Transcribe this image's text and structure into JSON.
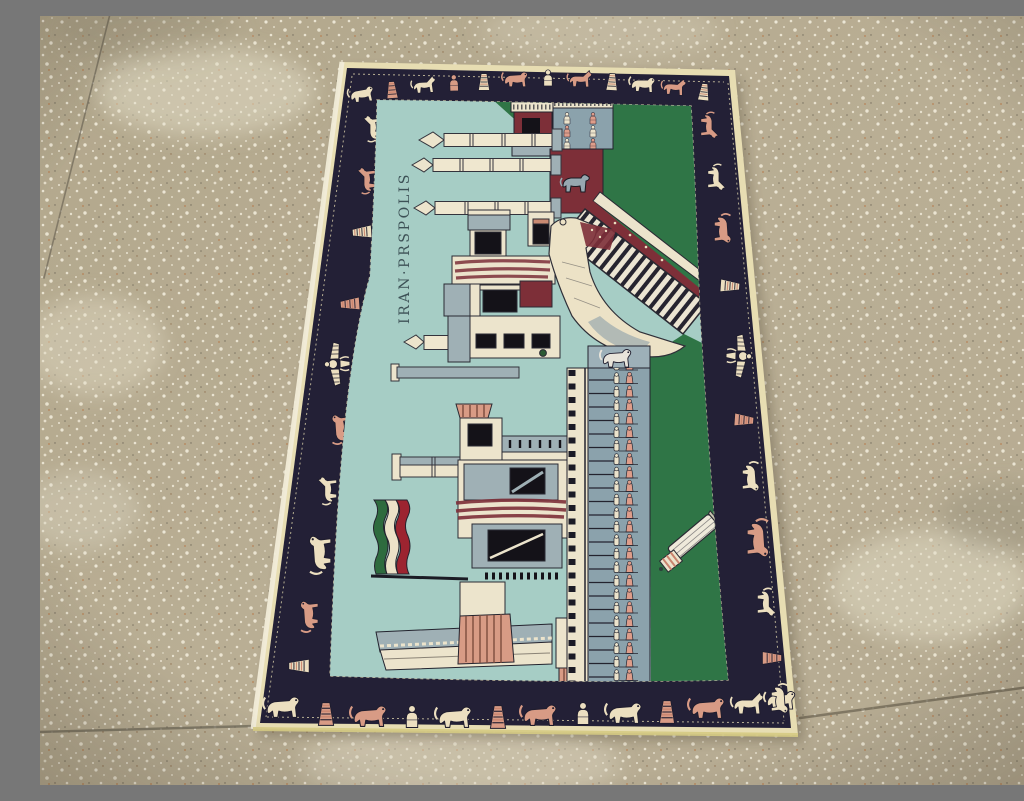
{
  "scene": {
    "description": "Photograph of a pictorial Persian rug depicting the ruins of Persepolis, lying flat on a speckled beige terrazzo floor",
    "floor": "speckled beige terrazzo with thin grout lines",
    "lighting": "soft indoor light, lighter patches on floor"
  },
  "rug": {
    "inscription": "IRAN·PRSPOLIS",
    "inscription_orientation": "woven vertically, reads bottom to top",
    "subject": "Persepolis ruins: columns, Gate of All Nations, grand staircase, soldier procession reliefs, bull relief panel, fallen column, flag of Iran",
    "border_motif_names": [
      "lion",
      "horse",
      "bull",
      "striped cone",
      "faravahar winged emblem",
      "seated figure"
    ],
    "flag_stripe_colors": [
      "#2e6b3e",
      "#ece2c8",
      "#9c2430"
    ],
    "border_motif_placements": [
      {
        "t": "lion",
        "x": 322,
        "y": 79,
        "r": -6,
        "s": 0.75,
        "c": "cream"
      },
      {
        "t": "cone",
        "x": 352,
        "y": 74,
        "r": -4,
        "s": 0.7,
        "c": "pink"
      },
      {
        "t": "horse",
        "x": 384,
        "y": 70,
        "r": -3,
        "s": 0.75,
        "c": "cream"
      },
      {
        "t": "figure",
        "x": 414,
        "y": 68,
        "r": -2,
        "s": 0.7,
        "c": "pink"
      },
      {
        "t": "cone",
        "x": 444,
        "y": 66,
        "r": 0,
        "s": 0.7,
        "c": "cream"
      },
      {
        "t": "lion",
        "x": 476,
        "y": 64,
        "r": 0,
        "s": 0.75,
        "c": "pink"
      },
      {
        "t": "figure",
        "x": 508,
        "y": 63,
        "r": 0,
        "s": 0.7,
        "c": "cream"
      },
      {
        "t": "horse",
        "x": 540,
        "y": 64,
        "r": 2,
        "s": 0.75,
        "c": "pink"
      },
      {
        "t": "cone",
        "x": 572,
        "y": 66,
        "r": 3,
        "s": 0.7,
        "c": "cream"
      },
      {
        "t": "lion",
        "x": 603,
        "y": 69,
        "r": 4,
        "s": 0.75,
        "c": "cream"
      },
      {
        "t": "horse",
        "x": 634,
        "y": 72,
        "r": 5,
        "s": 0.75,
        "c": "pink"
      },
      {
        "t": "cone",
        "x": 664,
        "y": 76,
        "r": 6,
        "s": 0.7,
        "c": "cream"
      },
      {
        "t": "lion",
        "x": 243,
        "y": 692,
        "r": 0,
        "s": 1.05,
        "c": "cream"
      },
      {
        "t": "cone",
        "x": 286,
        "y": 698,
        "r": 0,
        "s": 0.95,
        "c": "pink"
      },
      {
        "t": "lion",
        "x": 330,
        "y": 701,
        "r": 0,
        "s": 1.05,
        "c": "pink"
      },
      {
        "t": "figure",
        "x": 372,
        "y": 702,
        "r": 0,
        "s": 0.95,
        "c": "cream"
      },
      {
        "t": "lion",
        "x": 415,
        "y": 702,
        "r": 0,
        "s": 1.05,
        "c": "cream"
      },
      {
        "t": "cone",
        "x": 458,
        "y": 701,
        "r": 0,
        "s": 0.95,
        "c": "pink"
      },
      {
        "t": "lion",
        "x": 500,
        "y": 700,
        "r": 0,
        "s": 1.05,
        "c": "pink"
      },
      {
        "t": "figure",
        "x": 543,
        "y": 699,
        "r": 0,
        "s": 0.95,
        "c": "cream"
      },
      {
        "t": "lion",
        "x": 585,
        "y": 698,
        "r": 0,
        "s": 1.05,
        "c": "cream"
      },
      {
        "t": "cone",
        "x": 627,
        "y": 696,
        "r": 0,
        "s": 0.95,
        "c": "pink"
      },
      {
        "t": "lion",
        "x": 668,
        "y": 693,
        "r": 0,
        "s": 1.05,
        "c": "pink"
      },
      {
        "t": "horse",
        "x": 708,
        "y": 689,
        "r": 0,
        "s": 1.0,
        "c": "cream"
      },
      {
        "t": "lion",
        "x": 741,
        "y": 685,
        "r": 0,
        "s": 0.9,
        "c": "cream"
      },
      {
        "t": "horse",
        "x": 334,
        "y": 112,
        "r": -90,
        "s": 0.8,
        "c": "cream"
      },
      {
        "t": "horse",
        "x": 328,
        "y": 164,
        "r": -90,
        "s": 0.8,
        "c": "pink"
      },
      {
        "t": "cone",
        "x": 322,
        "y": 216,
        "r": -94,
        "s": 0.8,
        "c": "cream"
      },
      {
        "t": "cone",
        "x": 310,
        "y": 288,
        "r": -94,
        "s": 0.8,
        "c": "pink"
      },
      {
        "t": "faravahar",
        "x": 296,
        "y": 348,
        "r": -92,
        "s": 1.0,
        "c": "cream"
      },
      {
        "t": "lion",
        "x": 301,
        "y": 412,
        "r": -90,
        "s": 0.85,
        "c": "pink"
      },
      {
        "t": "horse",
        "x": 289,
        "y": 474,
        "r": -90,
        "s": 0.85,
        "c": "cream"
      },
      {
        "t": "lion",
        "x": 281,
        "y": 537,
        "r": -90,
        "s": 1.1,
        "c": "cream"
      },
      {
        "t": "lion",
        "x": 270,
        "y": 599,
        "r": -90,
        "s": 0.9,
        "c": "pink"
      },
      {
        "t": "cone",
        "x": 259,
        "y": 650,
        "r": -90,
        "s": 0.85,
        "c": "cream"
      },
      {
        "t": "horse",
        "x": 668,
        "y": 110,
        "r": 90,
        "s": 0.8,
        "c": "pink"
      },
      {
        "t": "horse",
        "x": 675,
        "y": 162,
        "r": 90,
        "s": 0.8,
        "c": "cream"
      },
      {
        "t": "lion",
        "x": 682,
        "y": 214,
        "r": 90,
        "s": 0.85,
        "c": "pink"
      },
      {
        "t": "cone",
        "x": 690,
        "y": 270,
        "r": 94,
        "s": 0.8,
        "c": "cream"
      },
      {
        "t": "faravahar",
        "x": 700,
        "y": 340,
        "r": 92,
        "s": 1.0,
        "c": "cream"
      },
      {
        "t": "cone",
        "x": 704,
        "y": 404,
        "r": 94,
        "s": 0.8,
        "c": "pink"
      },
      {
        "t": "lion",
        "x": 710,
        "y": 462,
        "r": 90,
        "s": 0.85,
        "c": "cream"
      },
      {
        "t": "lion",
        "x": 717,
        "y": 524,
        "r": 90,
        "s": 1.1,
        "c": "pink"
      },
      {
        "t": "horse",
        "x": 725,
        "y": 587,
        "r": 90,
        "s": 0.85,
        "c": "cream"
      },
      {
        "t": "cone",
        "x": 732,
        "y": 642,
        "r": 90,
        "s": 0.8,
        "c": "pink"
      },
      {
        "t": "lion",
        "x": 739,
        "y": 684,
        "r": 90,
        "s": 0.85,
        "c": "cream"
      }
    ]
  },
  "colors": {
    "floor": "#b7ac92",
    "floor_speckle": "#efe9d8",
    "grout": "#6e6757",
    "selvage": "#e7ddb2",
    "selvage_yellow": "#d6cb84",
    "border_navy": "#232036",
    "motif_cream": "#ecdfc0",
    "motif_pink": "#d89b85",
    "sky": "#a6cdc5",
    "grass": "#2f7546",
    "maroon": "#7d2f38",
    "stone_gray": "#8ba2ac",
    "stone_cream": "#ece4cc",
    "outline_dark": "#23232e",
    "inscription_ink": "#3d5156"
  }
}
